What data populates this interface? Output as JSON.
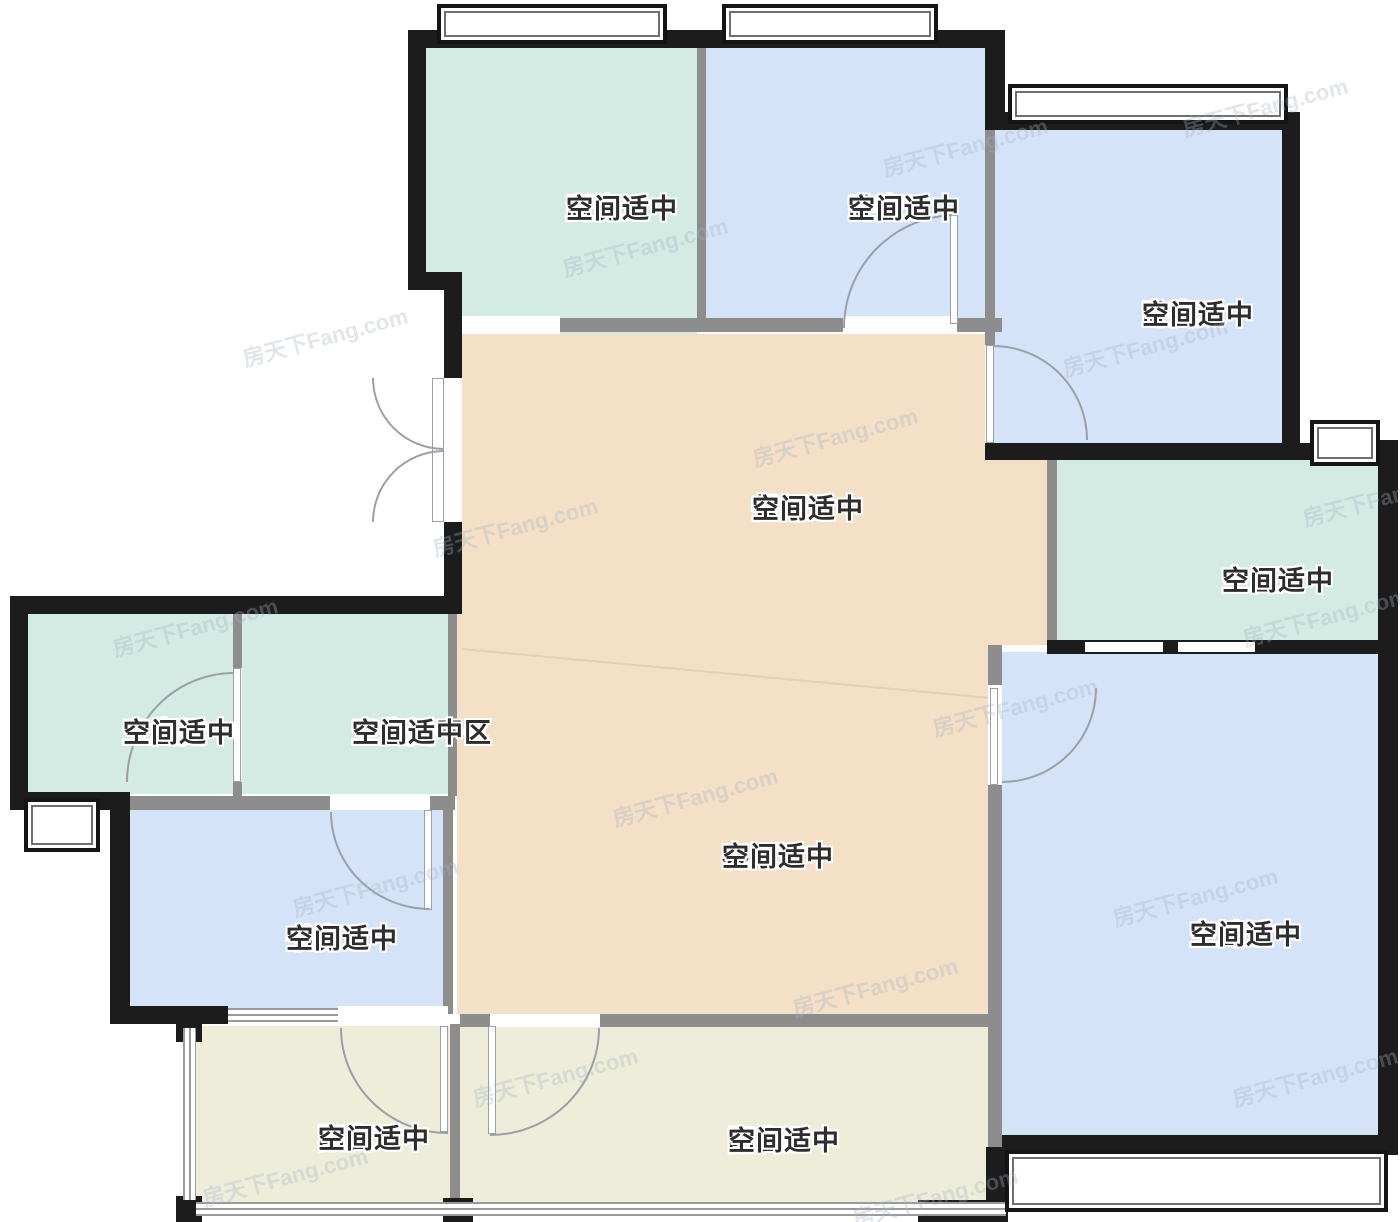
{
  "watermark": {
    "text": "房天下Fang.com"
  },
  "palette": {
    "wet_room_teal": "#d3ebe3",
    "bedroom_blue": "#d5e3f8",
    "hall_tan": "#f4dfc7",
    "balcony_yellow": "#ededd9",
    "exterior_wall": "#1c1c1c",
    "interior_wall": "#8d8d8d",
    "label_text": "#2d2d2d"
  },
  "rooms": [
    {
      "id": "kitchen",
      "name": "厨房",
      "note": "空间适中",
      "color": "#d3ebe3"
    },
    {
      "id": "bedroom",
      "name": "卧室",
      "note": "空间适中",
      "color": "#d5e3f8"
    },
    {
      "id": "bedroom-a",
      "name": "卧室A",
      "note": "空间适中",
      "color": "#d5e3f8"
    },
    {
      "id": "dining",
      "name": "餐厅",
      "note": "空间适中",
      "color": "#f4dfc7"
    },
    {
      "id": "master-bath",
      "name": "主卫",
      "note": "空间适中",
      "color": "#d3ebe3"
    },
    {
      "id": "bathroom",
      "name": "卫生间",
      "note": "空间适中",
      "color": "#d3ebe3"
    },
    {
      "id": "bathroom-dry",
      "name": "卫生间干区",
      "note": "空间适中",
      "color": "#d3ebe3"
    },
    {
      "id": "living",
      "name": "客厅",
      "note": "空间适中",
      "color": "#f4dfc7"
    },
    {
      "id": "study",
      "name": "书房",
      "note": "空间适中",
      "color": "#d5e3f8"
    },
    {
      "id": "master-bedroom",
      "name": "主卧",
      "note": "空间适中",
      "color": "#d5e3f8"
    },
    {
      "id": "balcony",
      "name": "阳台",
      "note": "空间适中",
      "color": "#ededd9"
    },
    {
      "id": "balcony-a",
      "name": "阳台A",
      "note": "空间适中",
      "color": "#ededd9"
    }
  ]
}
